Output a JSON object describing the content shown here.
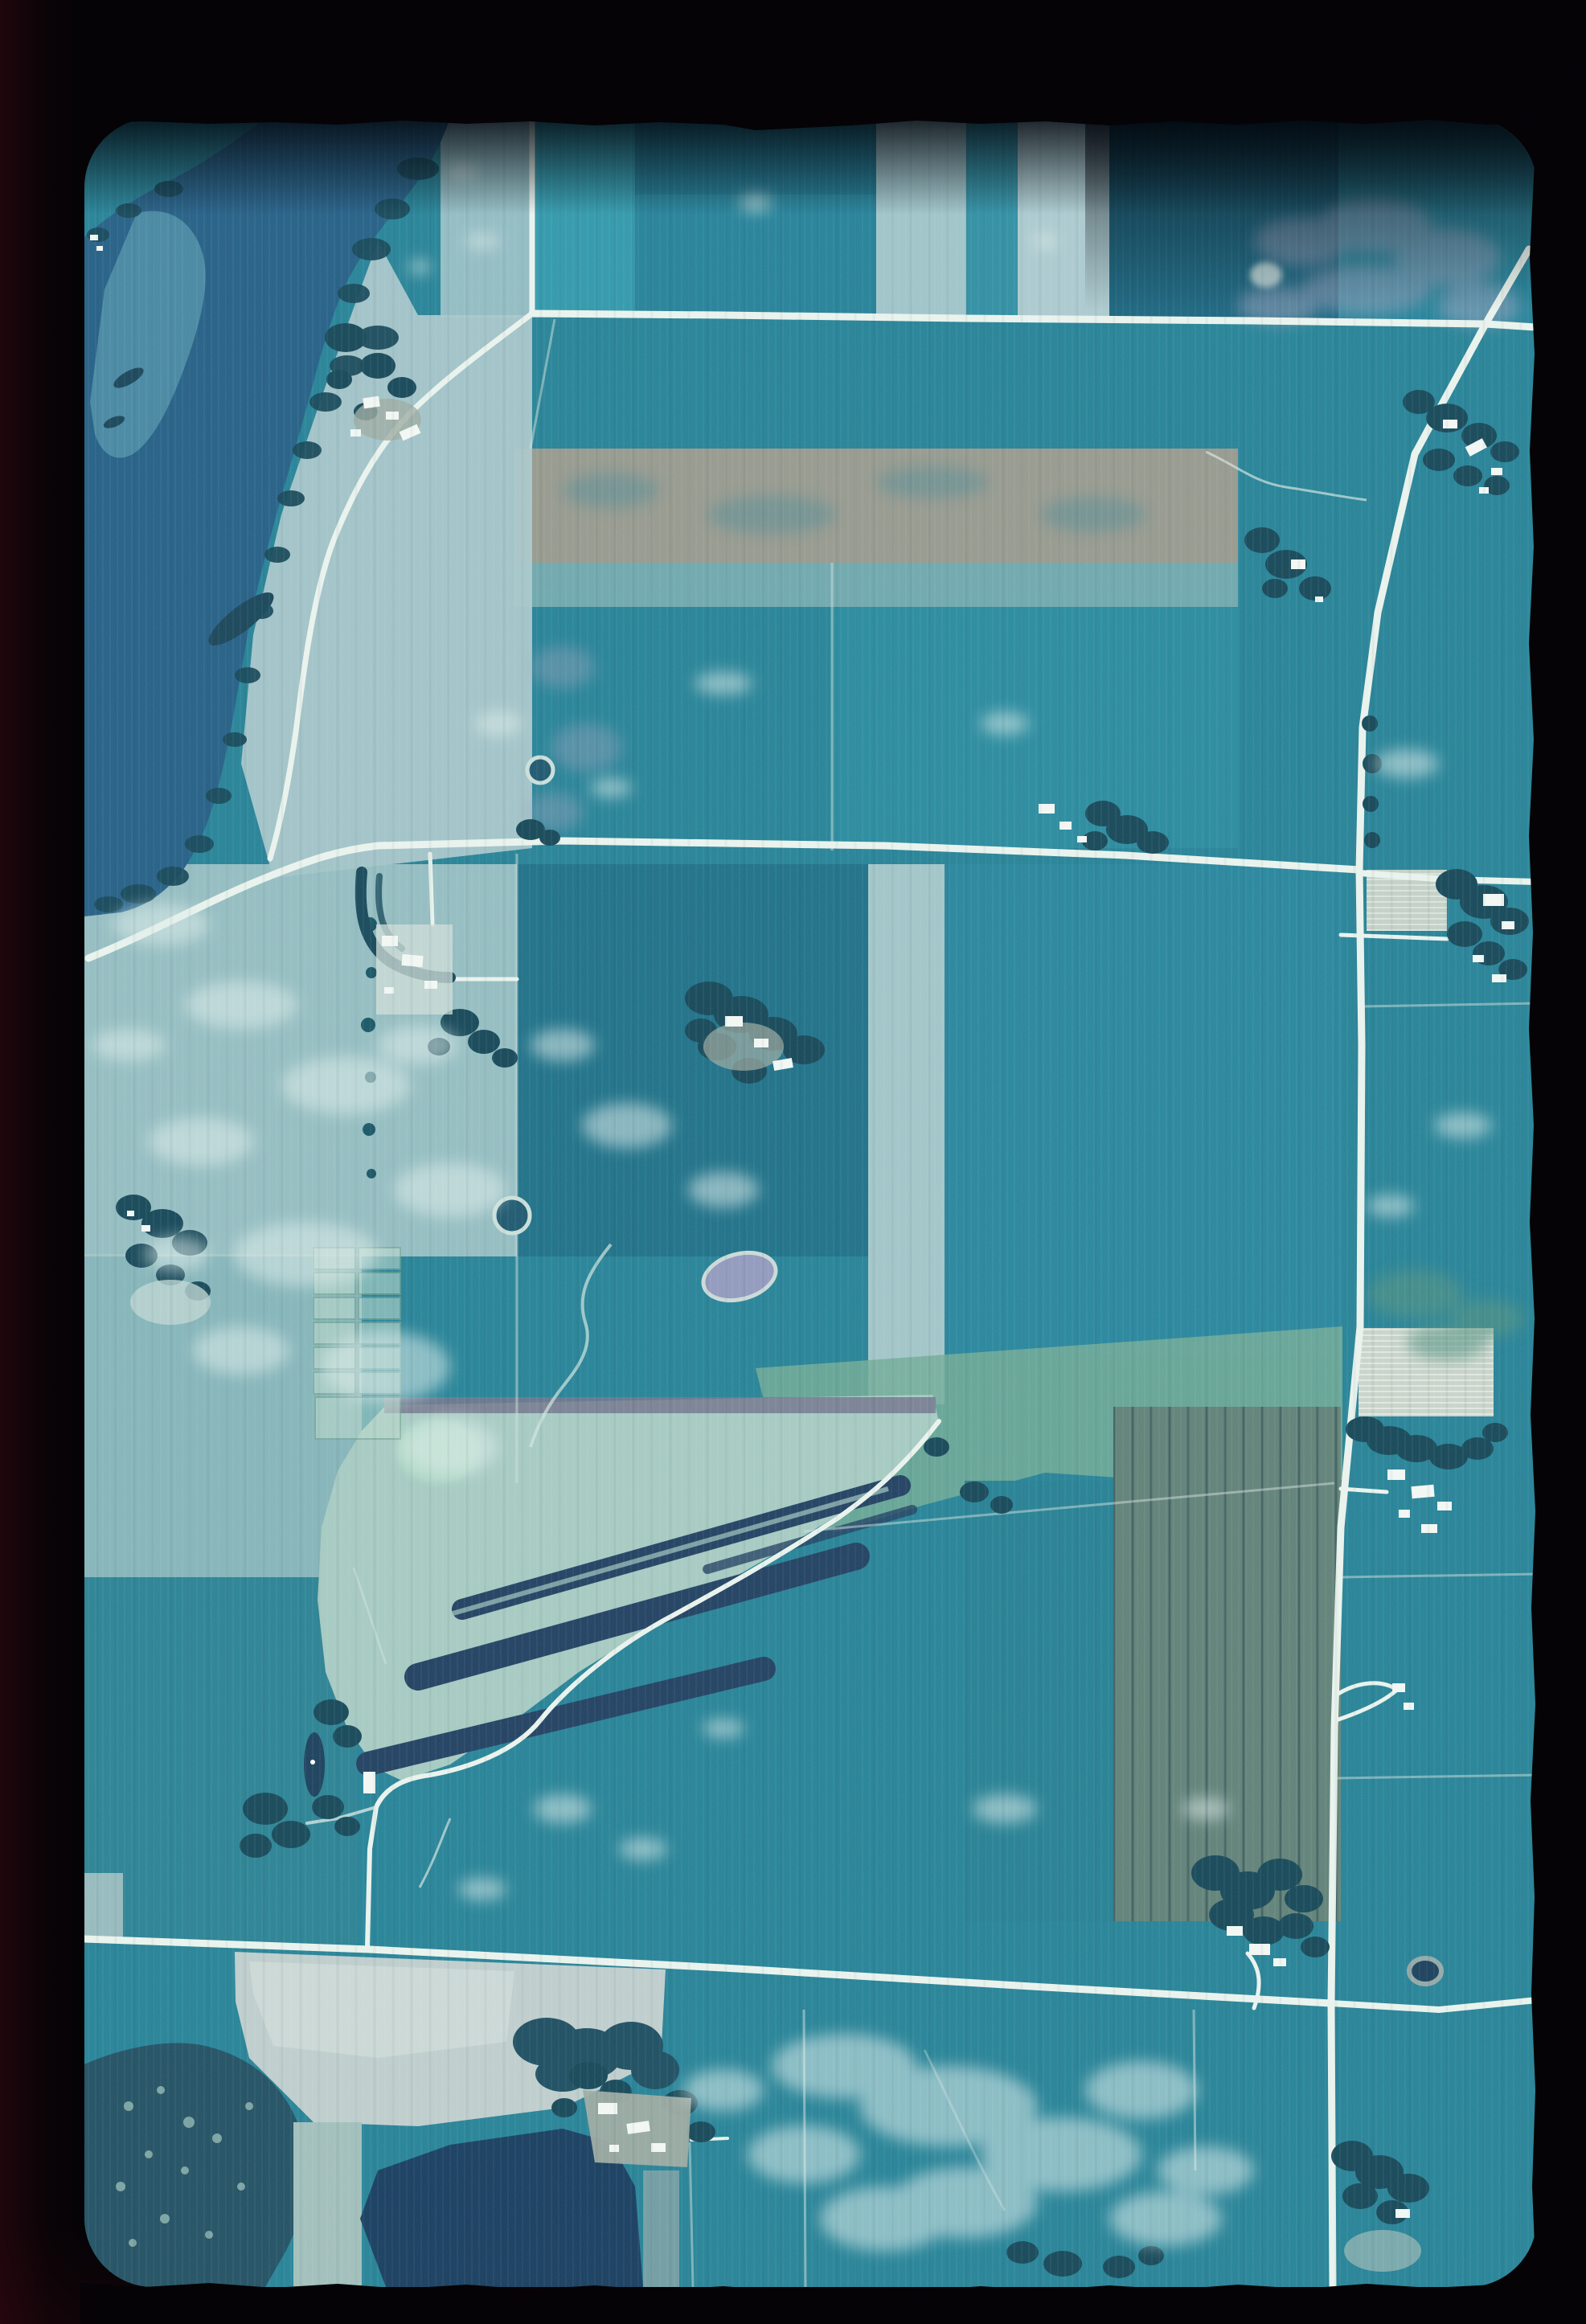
{
  "meta": {
    "kind": "scanned 35mm color slide of a vertical aerial photograph",
    "aria_label": "Cyan-toned aerial photograph slide of farmland: a lake with wooded shores at upper left, a grid of country roads, strip fields, scattered farmsteads with shelterbelts, a pale wedge-shaped field with dark drainage strips in the center, bare fields and dark ponds at the bottom, all inside a black slide mount with rounded corners.",
    "text_content": "none (no visible text in image)"
  },
  "palette": {
    "mount": "#050306",
    "field_base": "#1f7e93",
    "teal_bright": "#2b95a8",
    "teal_mid": "#1e7d95",
    "teal_dark": "#14607b",
    "teal_deep": "#176c84",
    "pale_field": "#9dc2c4",
    "pale_strip": "#9cc2c7",
    "pale_shore": "#a6c5c8",
    "lake": "#1e5a82",
    "lake_channel": "#4b8fa6",
    "tree": "#0e4152",
    "shore_tree": "#0f4254",
    "road": "#e9f2ec",
    "building": "#f2f7f3",
    "cloud": "#dcebe8",
    "brown_band": "#94968a",
    "brown_field": "#5c7d73",
    "sage_band": "#6da893",
    "mint": "#abd7c3",
    "wedge_field": "#a3c8bf",
    "wedge_strip": "#1a3a5c",
    "wedge_top_band": "#6f7188",
    "lavender_mottle": "#9aa0bc",
    "pond_lavender": "#8f96bb",
    "pond_dark": "#143a57",
    "big_pond": "#11375a",
    "woods": "#1b4b5e",
    "bare_field": "#bdcccb",
    "farmyard": "#9aa89e",
    "combed_field": "#c7d2c7"
  },
  "features": [
    {
      "id": "lake",
      "label": "lake with wooded shoreline",
      "position": "upper left"
    },
    {
      "id": "lake-islands",
      "label": "small wooded islands in the lake"
    },
    {
      "id": "road-top",
      "label": "east-west road across upper area"
    },
    {
      "id": "road-top-stub",
      "label": "road stub entering from top edge"
    },
    {
      "id": "road-diagonal",
      "label": "diagonal highway from upper-right corner"
    },
    {
      "id": "road-north-south",
      "label": "main north-south road along right side"
    },
    {
      "id": "road-middle",
      "label": "east-west road across the middle"
    },
    {
      "id": "road-shore",
      "label": "shore road along the lake"
    },
    {
      "id": "road-bottom",
      "label": "east-west road across the bottom"
    },
    {
      "id": "strip-fields",
      "label": "alternating light and dark crop strips, top band"
    },
    {
      "id": "brown-band",
      "label": "fallow brown-gray strip field"
    },
    {
      "id": "muck-wedge",
      "label": "pale wedge field with dark diagonal drainage strips"
    },
    {
      "id": "orchard-grid",
      "label": "small gridded plots"
    },
    {
      "id": "farmsteads",
      "label": "farmsteads with shelterbelt trees and white buildings"
    },
    {
      "id": "sloughs",
      "label": "small slough ponds and ring marshes"
    },
    {
      "id": "bare-field",
      "label": "bare pale field, bottom left"
    },
    {
      "id": "woods-bottom",
      "label": "dark wooded wetland and ponds, bottom"
    },
    {
      "id": "combed-fields",
      "label": "freshly tilled striped fields beside east road"
    },
    {
      "id": "cloud-haze",
      "label": "thin cloud haze patches"
    },
    {
      "id": "film-mount",
      "label": "black slide mount, rounded aperture, ragged film edges"
    }
  ]
}
